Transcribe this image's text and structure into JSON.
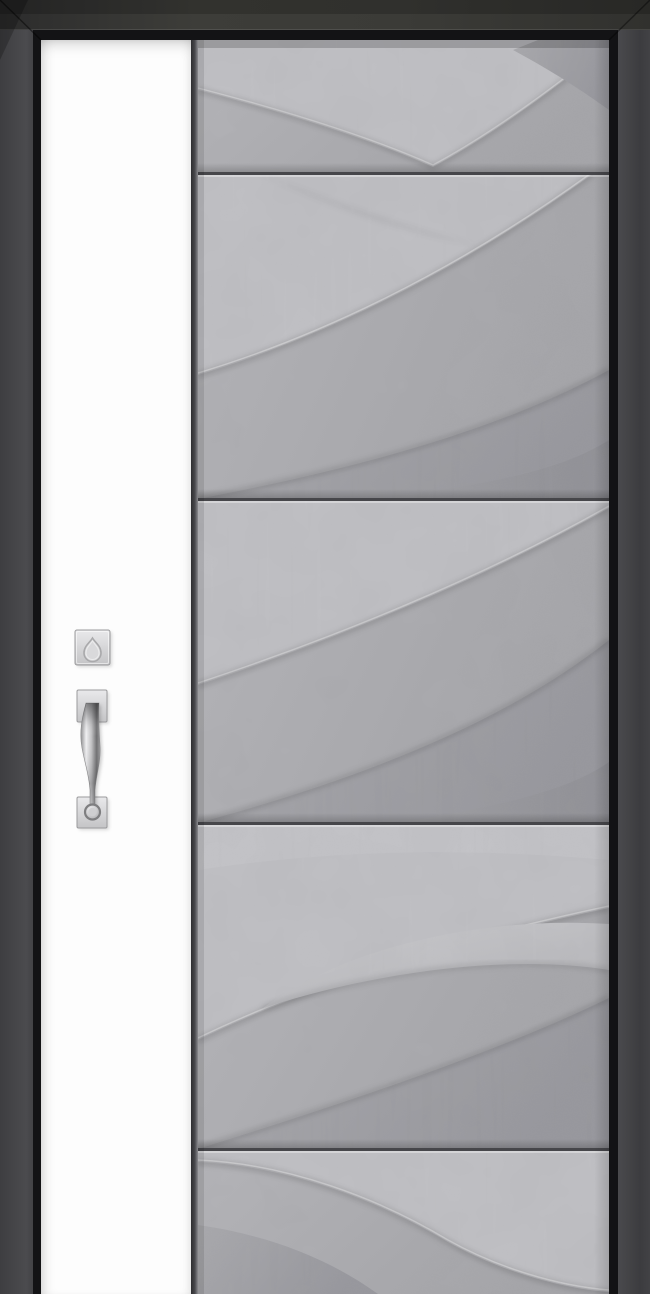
{
  "scene": {
    "subject": "modern-single-entry-door",
    "view": "front-product-render",
    "text_content": "none"
  },
  "door": {
    "frame": {
      "style": "dark-square-frame-with-black-inner-reveal"
    },
    "left_stile": {
      "finish": "plain-white"
    },
    "main_panel": {
      "finish": "light-gray-concrete",
      "relief": "sculpted-wave-leaf-pattern",
      "horizontal_grooves_count": 4,
      "horizontal_groove_y_px": [
        173,
        499,
        823,
        1149
      ]
    },
    "hardware": {
      "finish": "satin-nickel",
      "items": [
        {
          "name": "deadbolt-escutcheon",
          "shape": "square-plate-with-teardrop-keyhole"
        },
        {
          "name": "pull-handle-top-plate",
          "shape": "square-plate"
        },
        {
          "name": "pull-handle-grip",
          "shape": "curved-vertical-pull"
        },
        {
          "name": "pull-handle-bottom-plate",
          "shape": "square-plate"
        },
        {
          "name": "thumb-button",
          "shape": "round-button"
        }
      ]
    }
  },
  "colors": {
    "frame_outer": "#434346",
    "frame_top": "#383834",
    "frame_inner": "#131315",
    "stile": "#fdfdfd",
    "divider_dark": "#39393b",
    "concrete_light": "#c6c6ca",
    "concrete_mid": "#aeaeb2",
    "concrete_dark": "#98989c",
    "groove": "#46464a",
    "hardware_light": "#ececee",
    "hardware_mid": "#c6c6c8",
    "hardware_dark": "#7e7e80"
  }
}
